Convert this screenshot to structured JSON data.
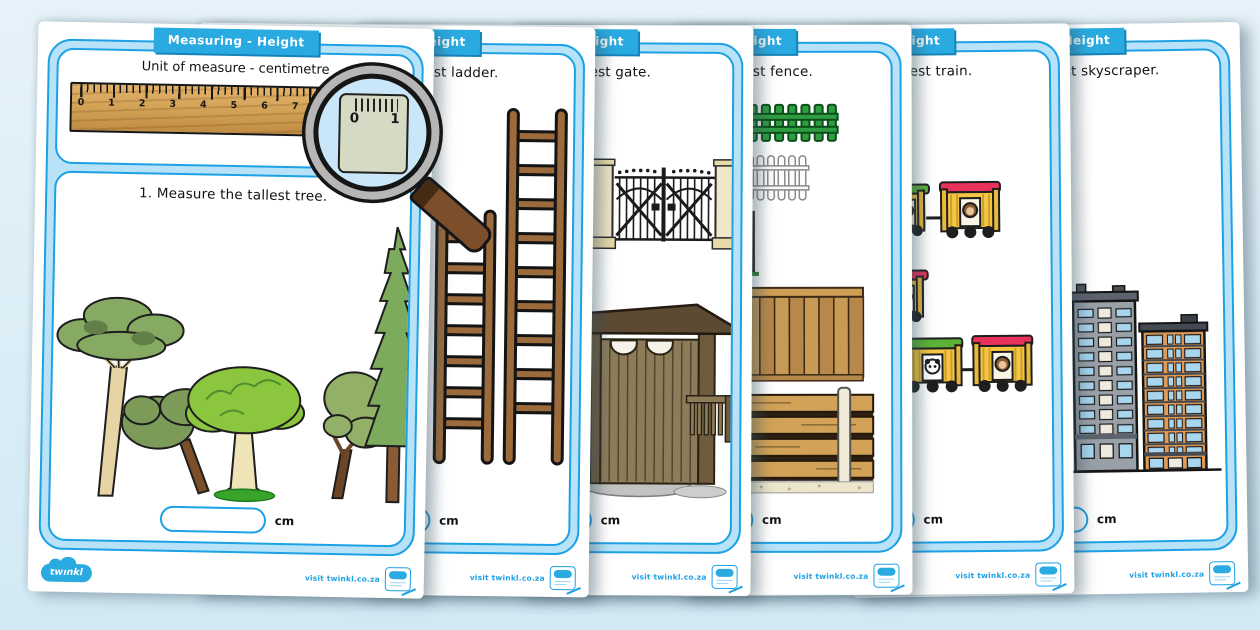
{
  "app": {
    "background_color": "#d7eaf5"
  },
  "banner": {
    "label": "Measuring - Height",
    "color": "#29abe2"
  },
  "frame_colors": {
    "band": "#b7e2f8",
    "line": "#1da1e5"
  },
  "ruler": {
    "numbers": [
      "0",
      "1",
      "2",
      "3",
      "4",
      "5",
      "6",
      "7",
      "8",
      "9",
      "10"
    ],
    "magnified": [
      "0",
      "1"
    ]
  },
  "footer": {
    "brand": "twinkl",
    "visit_label": "visit twinkl.co.za"
  },
  "pages": [
    {
      "task": "1. Measure the tallest tree.",
      "unit_heading": "Unit of measure - centimetre",
      "unit": "cm",
      "illustration": "trees"
    },
    {
      "task": "2. Measure the tallest ladder.",
      "unit": "cm",
      "illustration": "ladders"
    },
    {
      "task": "3. Measure the tallest gate.",
      "unit": "cm",
      "illustration": "gates"
    },
    {
      "task": "4. Measure the tallest fence.",
      "unit": "cm",
      "illustration": "fences"
    },
    {
      "task": "5. Measure the longest train.",
      "unit": "cm",
      "illustration": "trains"
    },
    {
      "task": "6. Measure the tallest skyscraper.",
      "unit": "cm",
      "illustration": "skyscrapers"
    }
  ]
}
